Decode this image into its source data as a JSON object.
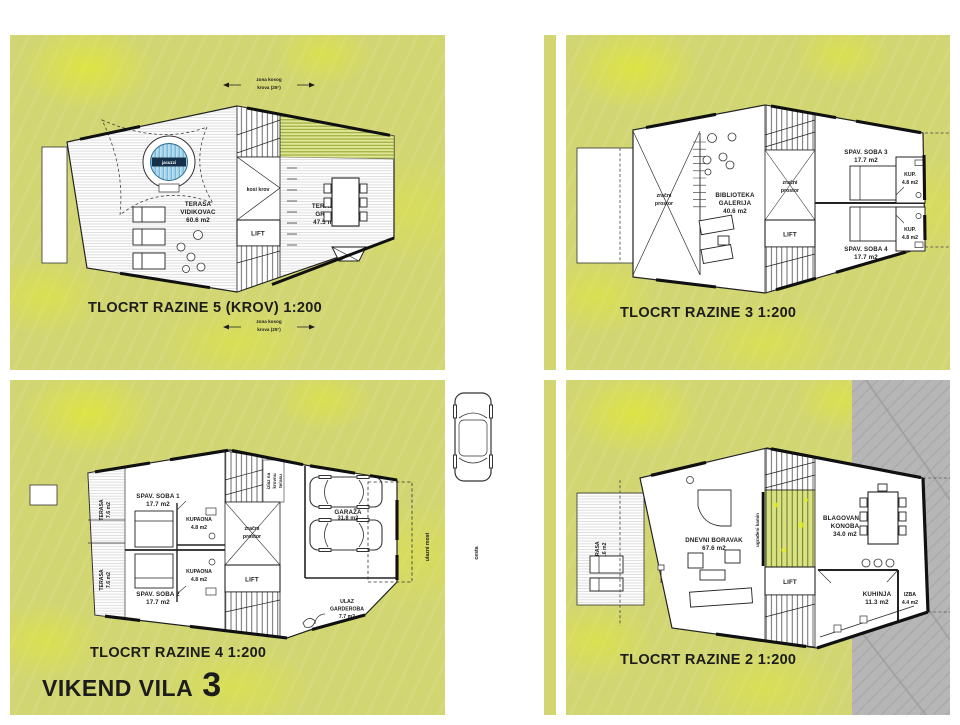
{
  "title": {
    "name": "VIKEND VILA",
    "number": "3"
  },
  "colors": {
    "ground_green": "#d2d672",
    "speckle_yellow": "#e4ec28",
    "rock_gray": "#b6b6b6",
    "pool_blue": "#74b6d8",
    "line_black": "#1c1c1c"
  },
  "plans": {
    "level5": {
      "caption": "TLOCRT RAZINE 5 (KROV) 1:200",
      "roof_zone_note": [
        "zona kosog",
        "krova (25°)"
      ],
      "labels": {
        "jacuzzi": "jacuzzi",
        "terasa_vidikovac": [
          "TERASA",
          "VIDIKOVAC",
          "60.6 m2"
        ],
        "kosi_krov": "kosi krov",
        "lift": "LIFT",
        "terasa_grill": [
          "TERASA",
          "GRILL",
          "47.5 m2"
        ]
      }
    },
    "level3": {
      "caption": "TLOCRT RAZINE 3 1:200",
      "labels": {
        "zracni_prostor": [
          "zračni",
          "prostor"
        ],
        "biblioteka_galerija": [
          "BIBLIOTEKA",
          "GALERIJA",
          "40.6 m2"
        ],
        "lift": "LIFT",
        "spav_soba_3": [
          "SPAV. SOBA 3",
          "17.7 m2"
        ],
        "spav_soba_4": [
          "SPAV. SOBA 4",
          "17.7 m2"
        ],
        "kupaonica": [
          "KUP.",
          "4.8 m2"
        ]
      }
    },
    "level4": {
      "caption": "TLOCRT RAZINE 4 1:200",
      "labels": {
        "terasa": [
          "TERASA",
          "7.6 m2"
        ],
        "spav_soba_1": [
          "SPAV. SOBA 1",
          "17.7 m2"
        ],
        "spav_soba_2": [
          "SPAV. SOBA 2",
          "17.7 m2"
        ],
        "kupaona": [
          "KUPAONA",
          "4.8 m2"
        ],
        "zracni_prostor": [
          "zračni",
          "prostor"
        ],
        "lift": "LIFT",
        "garaza": [
          "GARAŽA",
          "31.8 m2"
        ],
        "ulaz_garderoba": [
          "ULAZ",
          "GARDEROBA",
          "7.7 m2"
        ],
        "izlaz_note": [
          "izlaz na",
          "krovnu",
          "terasu"
        ],
        "ulazni_most": "ulazni most",
        "cesta": "cesta"
      }
    },
    "level2": {
      "caption": "TLOCRT RAZINE 2 1:200",
      "labels": {
        "terasa": [
          "TERASA",
          "23.6 m2"
        ],
        "dnevni_boravak": [
          "DNEVNI BORAVAK",
          "67.6 m2"
        ],
        "ugradeni_kamin": "ugrađeni kamin",
        "lift": "LIFT",
        "blagovanje_konoba": [
          "BLAGOVANJE",
          "KONOBA",
          "34.0 m2"
        ],
        "kuhinja": [
          "KUHINJA",
          "11.3 m2"
        ],
        "izba": [
          "IZBA",
          "4.4 m2"
        ]
      }
    }
  }
}
